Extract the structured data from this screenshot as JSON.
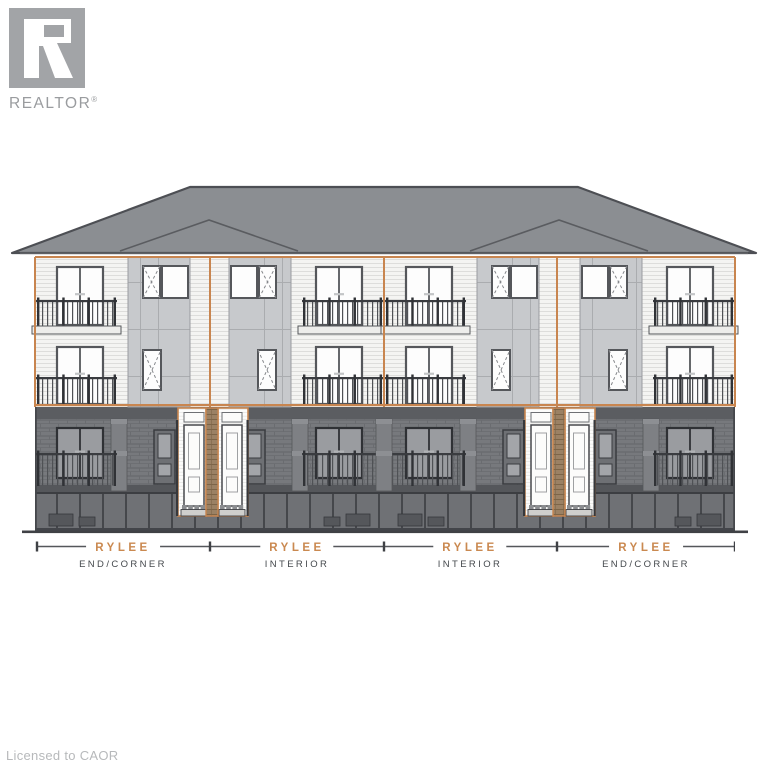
{
  "branding": {
    "logo_text": "REALTOR",
    "registered_mark": "®"
  },
  "elevation": {
    "building_name": "RYLEE",
    "units": [
      {
        "name": "RYLEE",
        "type": "END/CORNER"
      },
      {
        "name": "RYLEE",
        "type": "INTERIOR"
      },
      {
        "name": "RYLEE",
        "type": "INTERIOR"
      },
      {
        "name": "RYLEE",
        "type": "END/CORNER"
      }
    ],
    "colors": {
      "accent_orange": "#c8854f",
      "roof": "#8b8e92",
      "upper_siding": "#f4f4f2",
      "panel": "#c7c9cc",
      "ground_brick": "#77797d",
      "label_accent": "#ca8950",
      "label_text": "#45494d"
    }
  },
  "footer": {
    "license_text": "Licensed to CAOR"
  }
}
